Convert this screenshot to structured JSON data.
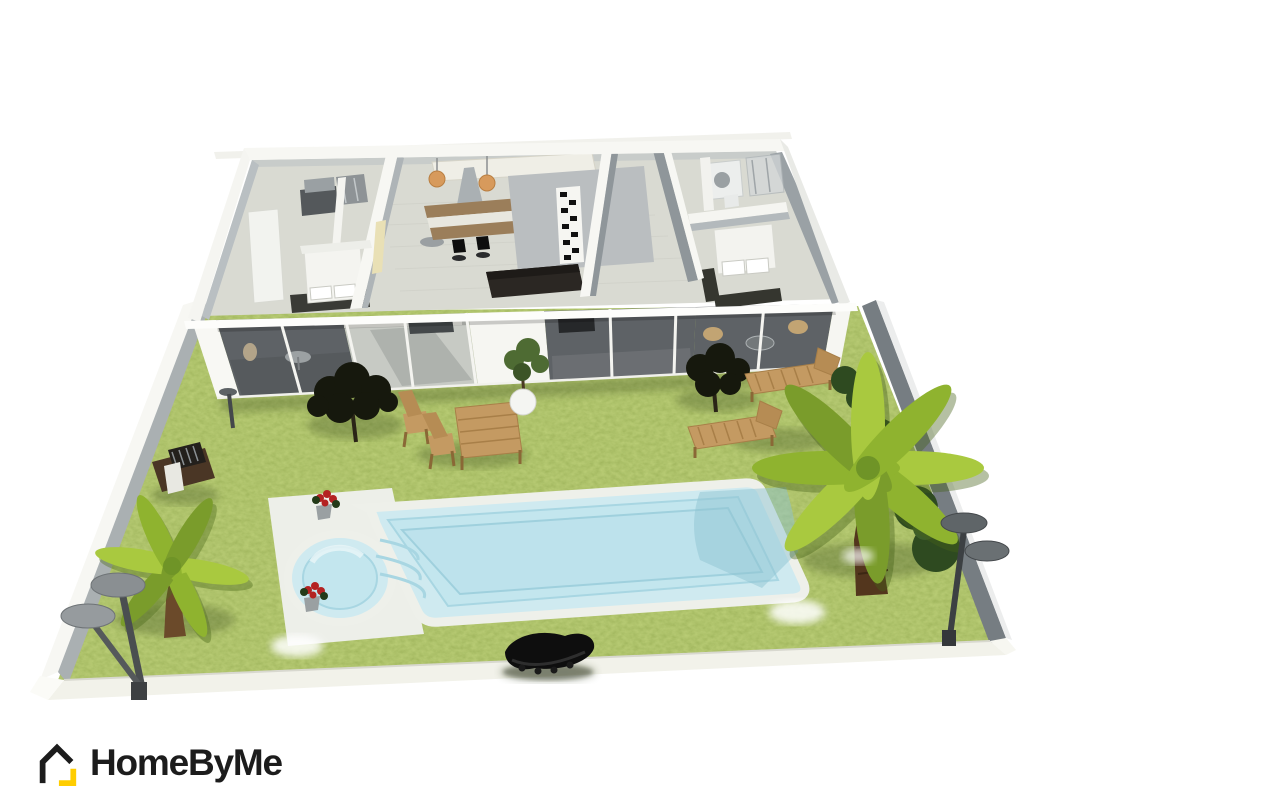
{
  "app": {
    "name": "HomeByMe"
  },
  "logo": {
    "text": "HomeByMe",
    "icon": "homebyme-house-icon",
    "text_color": "#1c1c1c",
    "accent_color": "#ffcd00"
  },
  "viewport": {
    "type": "3d-render",
    "view": "aerial dollhouse view of a single-storey house with garden and swimming pool",
    "background": "#ffffff"
  },
  "palette": {
    "viewport_bg": "#ffffff",
    "logo_text": "#1c1c1c",
    "accent": "#ffcd00",
    "grass": "#92ad48",
    "grass_shadow": "#2d3c12",
    "pool_water": "#cfeaf0",
    "pool_wall": "#c0e4ec",
    "pool_line": "#9fd0dd",
    "deck_white": "#edefe9",
    "wall_white": "#f7f7f3",
    "wall_shade": "#aab0b3",
    "wall_dark": "#767d82",
    "floor": "#d9dad2",
    "terrace_glass": "#5e6266",
    "terrace_open": "#c7cac4",
    "wood": "#c49a62",
    "wood_dark": "#a87f48",
    "foliage_dark": "#16180d",
    "palm_green": "#a9c93f",
    "palm_green_dark": "#7a9c2b",
    "hedge": "#2e4a20",
    "black_furniture": "#0e0e0e",
    "flower_red": "#b42222"
  },
  "scene": {
    "objects": [
      {
        "name": "house",
        "label": "single-storey house shown with roof removed"
      },
      {
        "name": "left-bedroom",
        "label": "bedroom with bed and wardrobe"
      },
      {
        "name": "left-bathroom",
        "label": "bathroom with vanity and shower"
      },
      {
        "name": "kitchen",
        "label": "kitchen with island, two bar stools and two pendant lights"
      },
      {
        "name": "living-room",
        "label": "living room with dark sofa and black-and-white decor column"
      },
      {
        "name": "hallway",
        "label": "hallway with pale yellow accent wall"
      },
      {
        "name": "right-bedroom",
        "label": "bedroom with double bed"
      },
      {
        "name": "right-bathroom",
        "label": "bathroom with shower and washing machine"
      },
      {
        "name": "terrace",
        "label": "covered terrace with glass sliding doors"
      },
      {
        "name": "perimeter-wall",
        "label": "white and grey wall around the lawn"
      },
      {
        "name": "lawn",
        "label": "grass garden"
      },
      {
        "name": "swimming-pool",
        "label": "swimming pool with round spa and steps"
      },
      {
        "name": "flower-pots",
        "label": "two pots of red flowers at the pool corner"
      },
      {
        "name": "black-lounger",
        "label": "curved black outdoor lounger"
      },
      {
        "name": "garden-table-set",
        "label": "wooden garden table with two folding chairs"
      },
      {
        "name": "sun-loungers",
        "label": "two wooden sun loungers"
      },
      {
        "name": "bbq-grill",
        "label": "barbecue grill table"
      },
      {
        "name": "small-palm-tree",
        "label": "small palm tree"
      },
      {
        "name": "large-palm-tree",
        "label": "large palm tree"
      },
      {
        "name": "dark-trees",
        "label": "two dark garden trees"
      },
      {
        "name": "garden-lamps",
        "label": "grey double-head garden lamps"
      },
      {
        "name": "potted-plant",
        "label": "plant in round white pot"
      },
      {
        "name": "hedges",
        "label": "dark hedges along the right wall"
      }
    ]
  }
}
